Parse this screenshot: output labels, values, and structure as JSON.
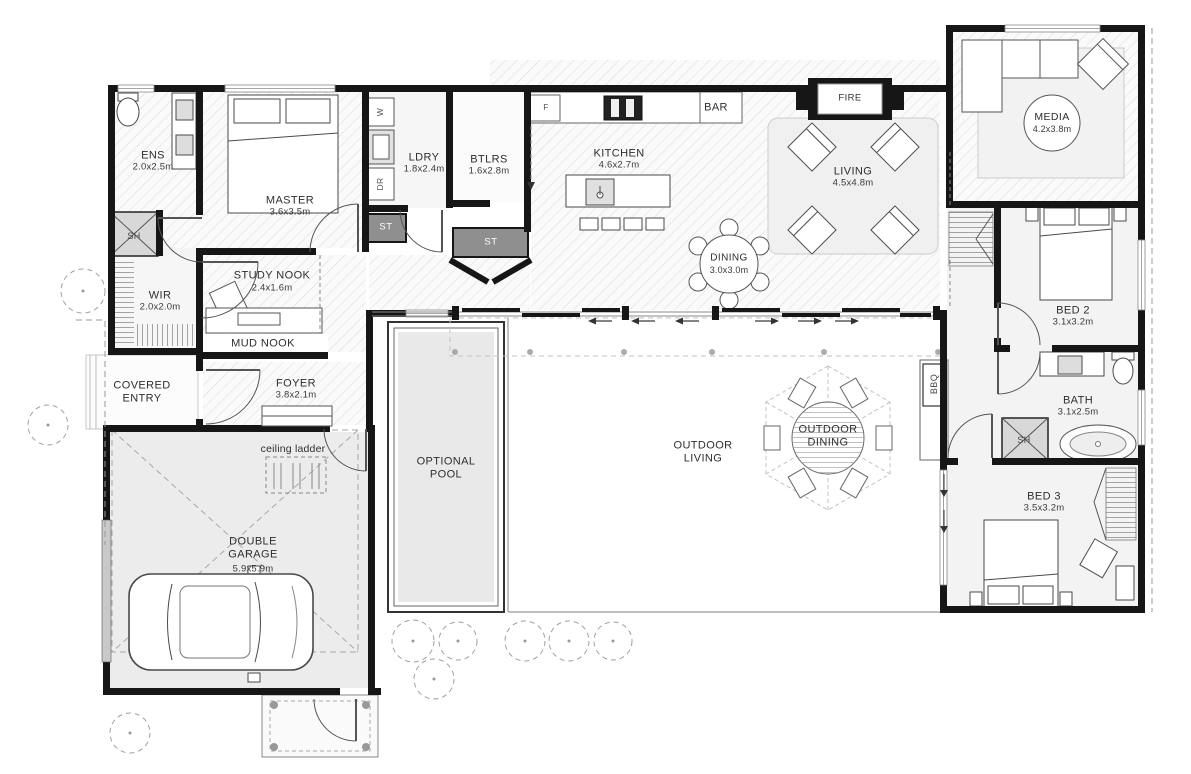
{
  "plan": {
    "rooms": {
      "ens": {
        "label": "ENS",
        "dims": "2.0x2.5m"
      },
      "master": {
        "label": "MASTER",
        "dims": "3.6x3.5m"
      },
      "wir": {
        "label": "WIR",
        "dims": "2.0x2.0m"
      },
      "study_nook": {
        "label": "STUDY NOOK",
        "dims": "2.4x1.6m"
      },
      "mud_nook": {
        "label": "MUD NOOK"
      },
      "ldry": {
        "label": "LDRY",
        "dims": "1.8x2.4m"
      },
      "btlrs": {
        "label": "BTLRS",
        "dims": "1.6x2.8m"
      },
      "kitchen": {
        "label": "KITCHEN",
        "dims": "4.6x2.7m"
      },
      "living": {
        "label": "LIVING",
        "dims": "4.5x4.8m"
      },
      "dining": {
        "label": "DINING",
        "dims": "3.0x3.0m"
      },
      "media": {
        "label": "MEDIA",
        "dims": "4.2x3.8m"
      },
      "bed2": {
        "label": "BED 2",
        "dims": "3.1x3.2m"
      },
      "bath": {
        "label": "BATH",
        "dims": "3.1x2.5m"
      },
      "bed3": {
        "label": "BED 3",
        "dims": "3.5x3.2m"
      },
      "foyer": {
        "label": "FOYER",
        "dims": "3.8x2.1m"
      },
      "garage": {
        "label": "DOUBLE GARAGE",
        "dims": "5.9x5.9m"
      },
      "covered_entry": {
        "label": "COVERED ENTRY"
      },
      "pool": {
        "label": "OPTIONAL POOL"
      },
      "outdoor_living": {
        "label": "OUTDOOR LIVING"
      },
      "outdoor_dining": {
        "label": "OUTDOOR DINING"
      }
    },
    "fixtures": {
      "fire": "FIRE",
      "bar": "BAR",
      "bbq": "BBQ",
      "fridge": "F",
      "washer": "W",
      "dryer": "DR",
      "storage": "ST",
      "shower": "SH",
      "ceiling_ladder": "ceiling ladder"
    },
    "colors": {
      "wall": "#161616",
      "hatch_line": "#dcdcdc",
      "storage_fill": "#8f8f8f",
      "shower_fill": "#d8d8d8",
      "pool_water": "#e9e9e9"
    }
  }
}
